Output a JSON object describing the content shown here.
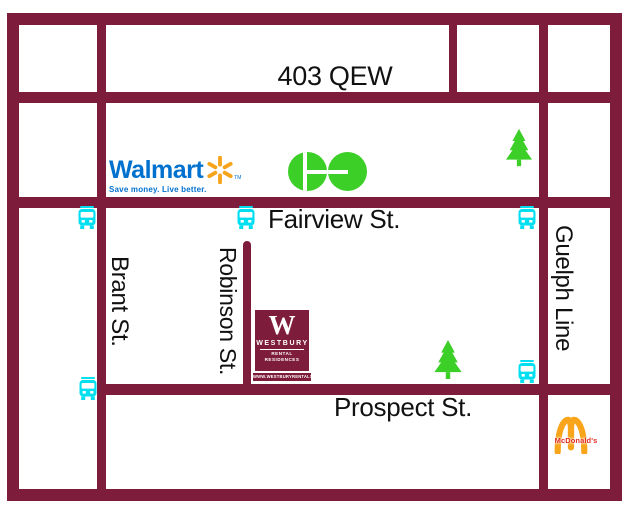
{
  "map": {
    "title": "Westbury Rental Residences location map",
    "streets": {
      "highway": "403 QEW",
      "fairview": "Fairview St.",
      "prospect": "Prospect St.",
      "brant": "Brant St.",
      "robinson": "Robinson St.",
      "guelph": "Guelph Line"
    },
    "logos": {
      "walmart": {
        "name": "Walmart",
        "tm": "TM",
        "tagline": "Save money. Live better."
      },
      "go": {
        "name": "GO"
      },
      "westbury": {
        "initial": "W",
        "name": "WESTBURY",
        "subtitle": "RENTAL RESIDENCES",
        "website": "WWW.WESTBURYRENTALS.COM"
      },
      "mcdonalds": {
        "name": "McDonald's"
      }
    },
    "icons": {
      "bus": "bus-stop-icon",
      "tree": "tree-icon",
      "bus_count": 5,
      "tree_count": 2
    },
    "colors": {
      "background": "#ffffff",
      "road": "#7e1c3c",
      "label_text": "#111111",
      "bus": "#00dff0",
      "tree": "#3ccf27",
      "go_green": "#3ccf27",
      "walmart_blue": "#0071ce",
      "walmart_orange": "#f7a41d",
      "mcdonalds_gold": "#f9a51b",
      "mcdonalds_red": "#e02b20"
    }
  }
}
